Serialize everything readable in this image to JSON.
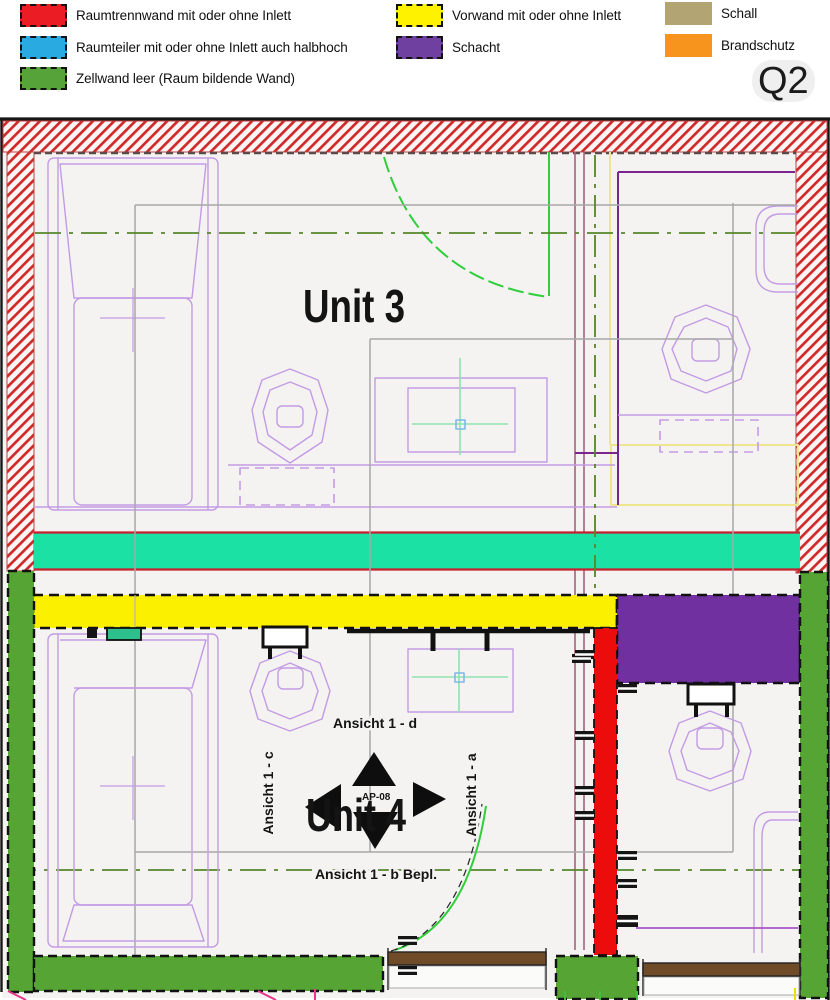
{
  "legend": {
    "items": [
      {
        "label": "Raumtrennwand mit oder ohne Inlett",
        "color": "#EC1C24",
        "style": "dashed"
      },
      {
        "label": "Raumteiler mit oder ohne Inlett auch halbhoch",
        "color": "#29ABE2",
        "style": "dashed"
      },
      {
        "label": "Zellwand leer (Raum bildende Wand)",
        "color": "#56A339",
        "style": "dashed"
      },
      {
        "label": "Vorwand mit oder ohne Inlett",
        "color": "#FFF200",
        "style": "dashed"
      },
      {
        "label": "Schacht",
        "color": "#7040A0",
        "style": "dashed"
      },
      {
        "label": "Schall",
        "color": "#B3A573",
        "style": "solid"
      },
      {
        "label": "Brandschutz",
        "color": "#F7941E",
        "style": "solid"
      }
    ],
    "sheet_label": "Q2"
  },
  "plan": {
    "units": {
      "unit3": "Unit 3",
      "unit4": "Unit 4"
    },
    "marker": "AP-08",
    "views": {
      "d": "Ansicht 1 - d",
      "c": "Ansicht 1 - c",
      "a": "Ansicht 1 - a",
      "b": "Ansicht 1 - b Bepl."
    },
    "colors": {
      "hatch_red": "#CE2A2A",
      "band_teal": "#1BE2A4",
      "band_border_red": "#C81E2E",
      "wall_red": "#ED0C0C",
      "wall_green": "#55A434",
      "vorwand_yellow": "#FBF000",
      "schacht_purple": "#7030A0",
      "wood_brown": "#6F4B28",
      "cad_purple_light": "#C39BE4",
      "cad_purple_dark": "#7B2490",
      "centerline_green": "#55862B",
      "door_green": "#2FCF3A",
      "mint_green": "#8FE3AE",
      "pink_mark": "#E8348B"
    }
  }
}
